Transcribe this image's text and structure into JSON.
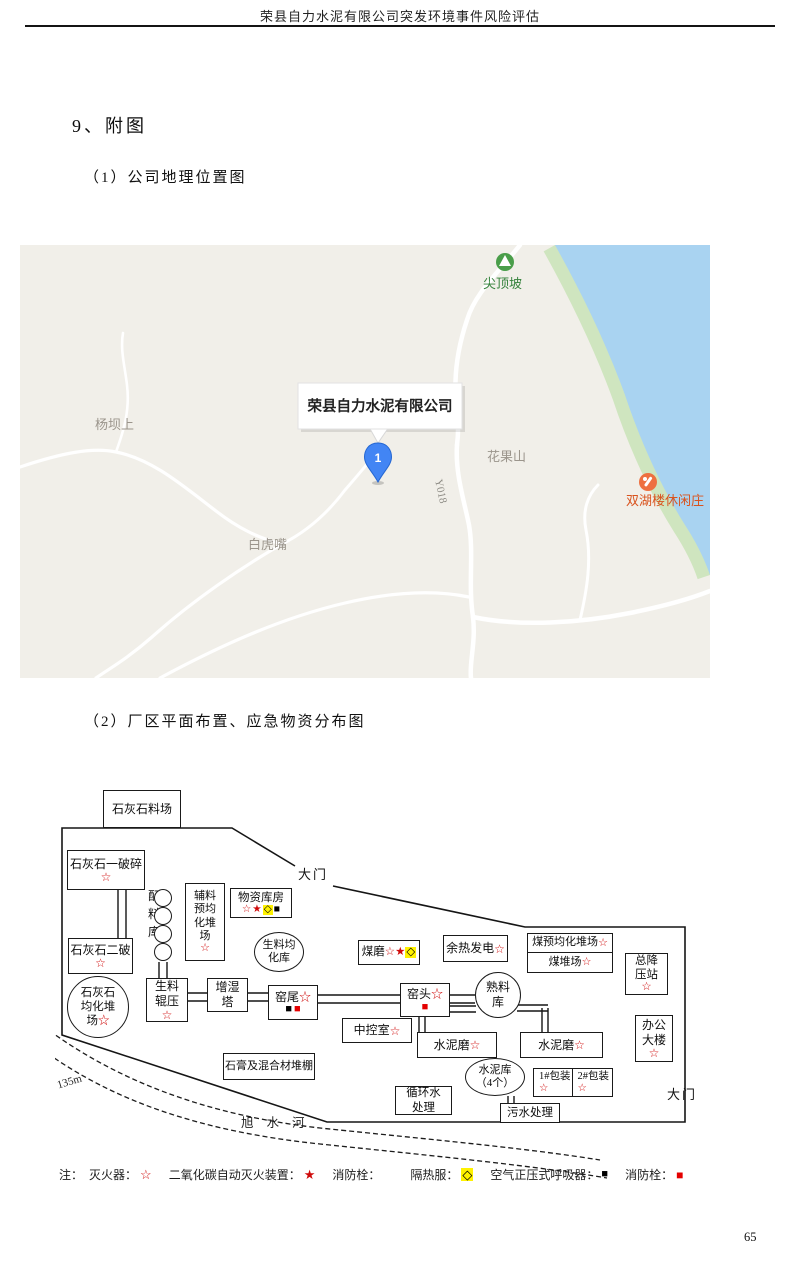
{
  "page": {
    "header": "荣县自力水泥有限公司突发环境事件风险评估",
    "page_number": "65"
  },
  "headings": {
    "section": "9、附图",
    "fig1": "（1）公司地理位置图",
    "fig2": "（2）厂区平面布置、应急物资分布图"
  },
  "map": {
    "tooltip": "荣县自力水泥有限公司",
    "marker": "1",
    "peak": "尖顶坡",
    "village_left": "杨坝上",
    "village_bottom": "白虎嘴",
    "hill_right": "花果山",
    "restaurant": "双湖楼休闲庄",
    "road_code": "Y018",
    "colors": {
      "land": "#f1efe9",
      "water": "#a9d3f1",
      "shore": "#cfe5bf",
      "poi_green": "#4a9e4a",
      "poi_orange": "#ee7040",
      "label_gray": "#9b958c"
    }
  },
  "plant": {
    "boxes": {
      "limestone_yard": "石灰石料场",
      "crusher1": "石灰石一破碎",
      "crusher2": "石灰石二破",
      "limestone_homo": "石灰石\n均化堆\n场",
      "batching": "配\n料\n库",
      "aux_homo": "辅料\n预均\n化堆\n场",
      "supplies": "物资库房",
      "raw_homo": "生料均\n化库",
      "raw_roller": "生料\n辊压",
      "humidify_tower": "增湿\n塔",
      "kiln_tail": "窑尾",
      "kiln_head": "窑头",
      "clinker": "熟料\n库",
      "coal_mill": "煤磨",
      "waste_heat": "余热发电",
      "coal_homo": "煤预均化堆场",
      "coal_yard": "煤堆场",
      "substation": "总降\n压站",
      "office": "办公\n大楼",
      "control_room": "中控室",
      "cement_mill1": "水泥磨",
      "cement_mill2": "水泥磨",
      "gypsum_shed": "石膏及混合材堆棚",
      "cement_silo": "水泥库\n（4个）",
      "pack1": "1#包装",
      "pack2": "2#包装",
      "circulating_water": "循环水\n处理",
      "sewage": "污水处理"
    },
    "gate_top": "大门",
    "gate_right": "大门",
    "river": "旭水河",
    "distance": "135m",
    "symbols": {
      "extinguisher": "☆",
      "co2": "★",
      "suit": "◇",
      "respirator": "■",
      "hydrant": "■",
      "none": ""
    },
    "legend": {
      "note": "注：",
      "ext_label": "灭火器：",
      "co2_label": "二氧化碳自动灭火装置：",
      "hydrant1_label": "消防栓：",
      "suit_label": "隔热服：",
      "resp_label": "空气正压式呼吸器：",
      "hydrant2_label": "消防栓："
    }
  }
}
